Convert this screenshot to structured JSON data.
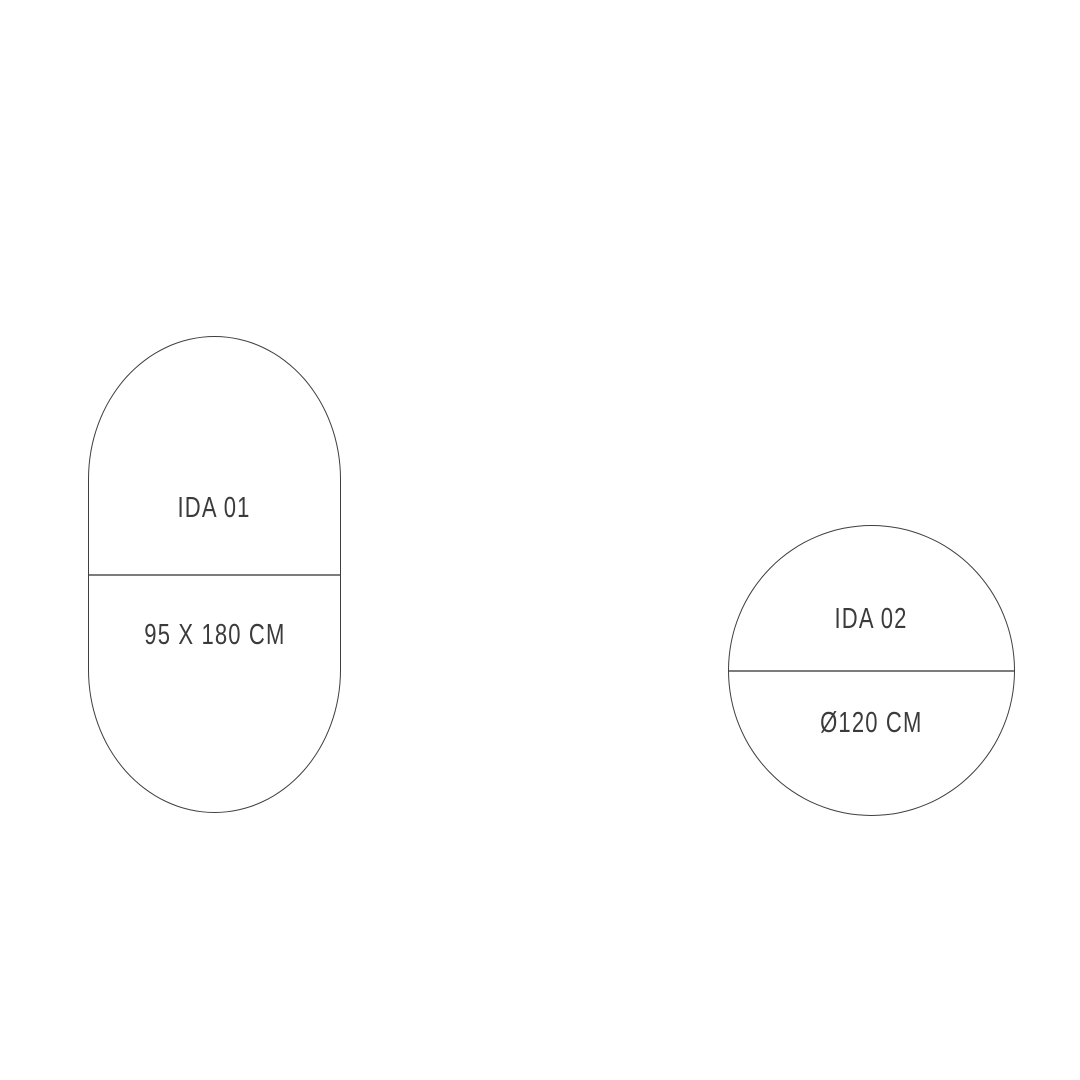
{
  "diagram": {
    "kind": "product-size-diagram",
    "background": "#ffffff",
    "colors": {
      "outline": "#3f3f3f",
      "divider": "#7c7c7c",
      "text": "#3b3b3b"
    }
  },
  "products": [
    {
      "name": "IDA 01",
      "dimensions": "95 X 180 CM",
      "shape": "rounded-oblong"
    },
    {
      "name": "IDA 02",
      "dimensions": "Ø120 CM",
      "shape": "circle"
    }
  ]
}
